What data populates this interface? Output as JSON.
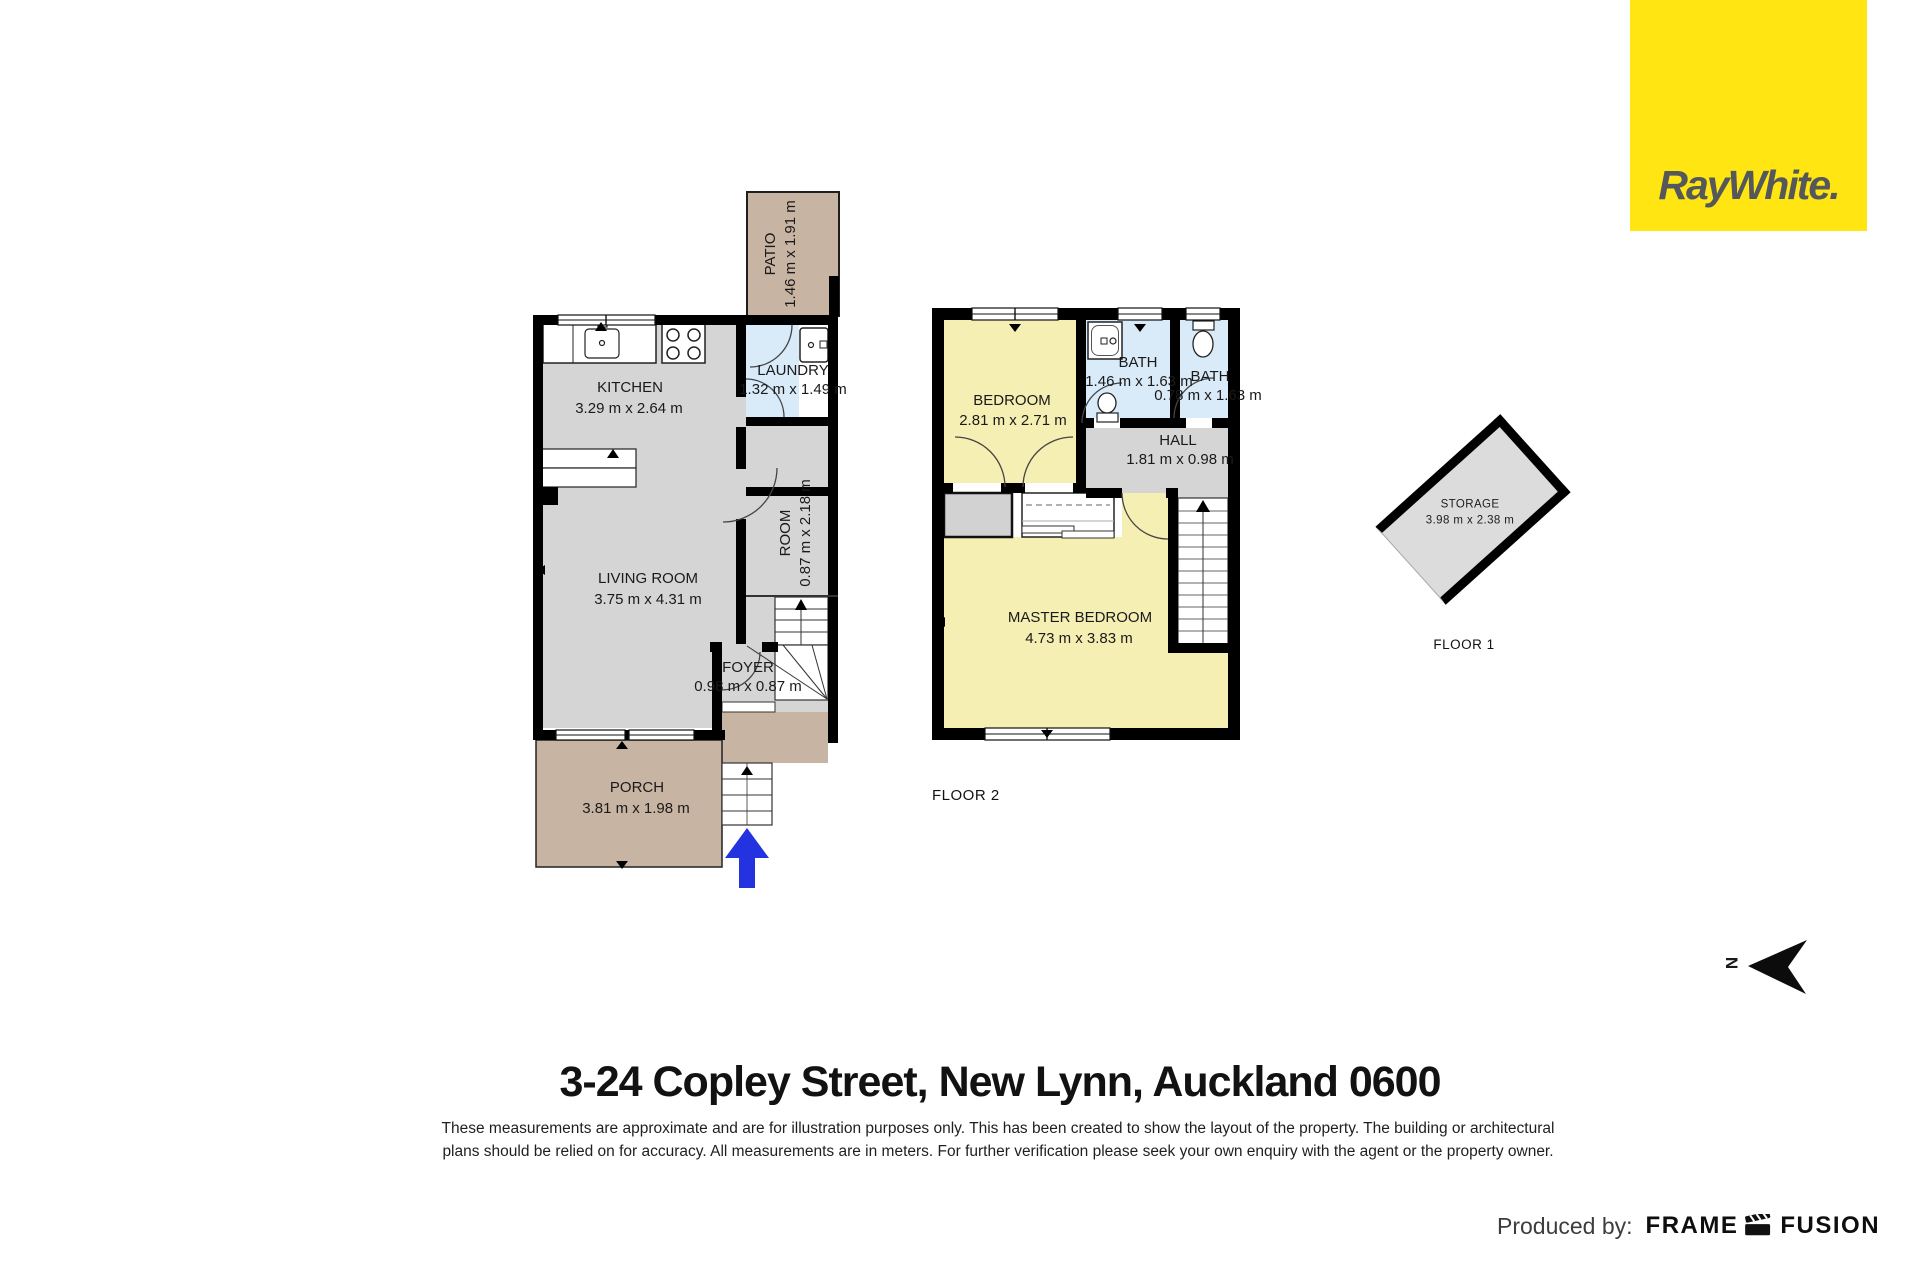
{
  "brand": {
    "name": "RayWhite.",
    "bg_color": "#FFE512",
    "text_color": "#54585B"
  },
  "floor_plan_1": {
    "rooms": {
      "patio": {
        "name": "PATIO",
        "dims": "1.46 m x 1.91 m"
      },
      "kitchen": {
        "name": "KITCHEN",
        "dims": "3.29 m x 2.64 m"
      },
      "laundry": {
        "name": "LAUNDRY",
        "dims": "1.32 m x 1.49 m"
      },
      "living": {
        "name": "LIVING ROOM",
        "dims": "3.75 m x 4.31 m"
      },
      "room": {
        "name": "ROOM",
        "dims": "0.87 m x 2.18 m"
      },
      "foyer": {
        "name": "FOYER",
        "dims": "0.98 m x 0.87 m"
      },
      "porch": {
        "name": "PORCH",
        "dims": "3.81 m x 1.98 m"
      }
    }
  },
  "floor_plan_2": {
    "label": "FLOOR 2",
    "rooms": {
      "bedroom": {
        "name": "BEDROOM",
        "dims": "2.81 m x 2.71 m"
      },
      "bath1": {
        "name": "BATH",
        "dims": "1.46 m x 1.63 m"
      },
      "bath2": {
        "name": "BATH",
        "dims": "0.78 m x 1.63 m"
      },
      "hall": {
        "name": "HALL",
        "dims": "1.81 m x 0.98 m"
      },
      "master": {
        "name": "MASTER BEDROOM",
        "dims": "4.73 m x 3.83 m"
      }
    }
  },
  "storage_plan": {
    "label": "FLOOR 1",
    "room": {
      "name": "STORAGE",
      "dims": "3.98 m x 2.38 m"
    }
  },
  "compass": {
    "label": "N"
  },
  "footer": {
    "address": "3-24 Copley Street, New Lynn, Auckland 0600",
    "disclaimer_line1": "These measurements are approximate and are for illustration purposes only. This has been created to show the layout of the property. The building or architectural",
    "disclaimer_line2": "plans should be relied on for accuracy. All measurements are in meters. For further verification please seek your own enquiry with the agent or the property owner.",
    "produced_by": "Produced by:",
    "producer_word1": "FRAME",
    "producer_word2": "FUSION"
  },
  "colors": {
    "wall": "#000000",
    "floor_gray": "#d5d5d5",
    "outdoor_tan": "#c8b4a2",
    "bedroom_yellow": "#f6efb4",
    "bath_blue": "#d9eaf8",
    "entry_arrow_blue": "#2433E0"
  }
}
